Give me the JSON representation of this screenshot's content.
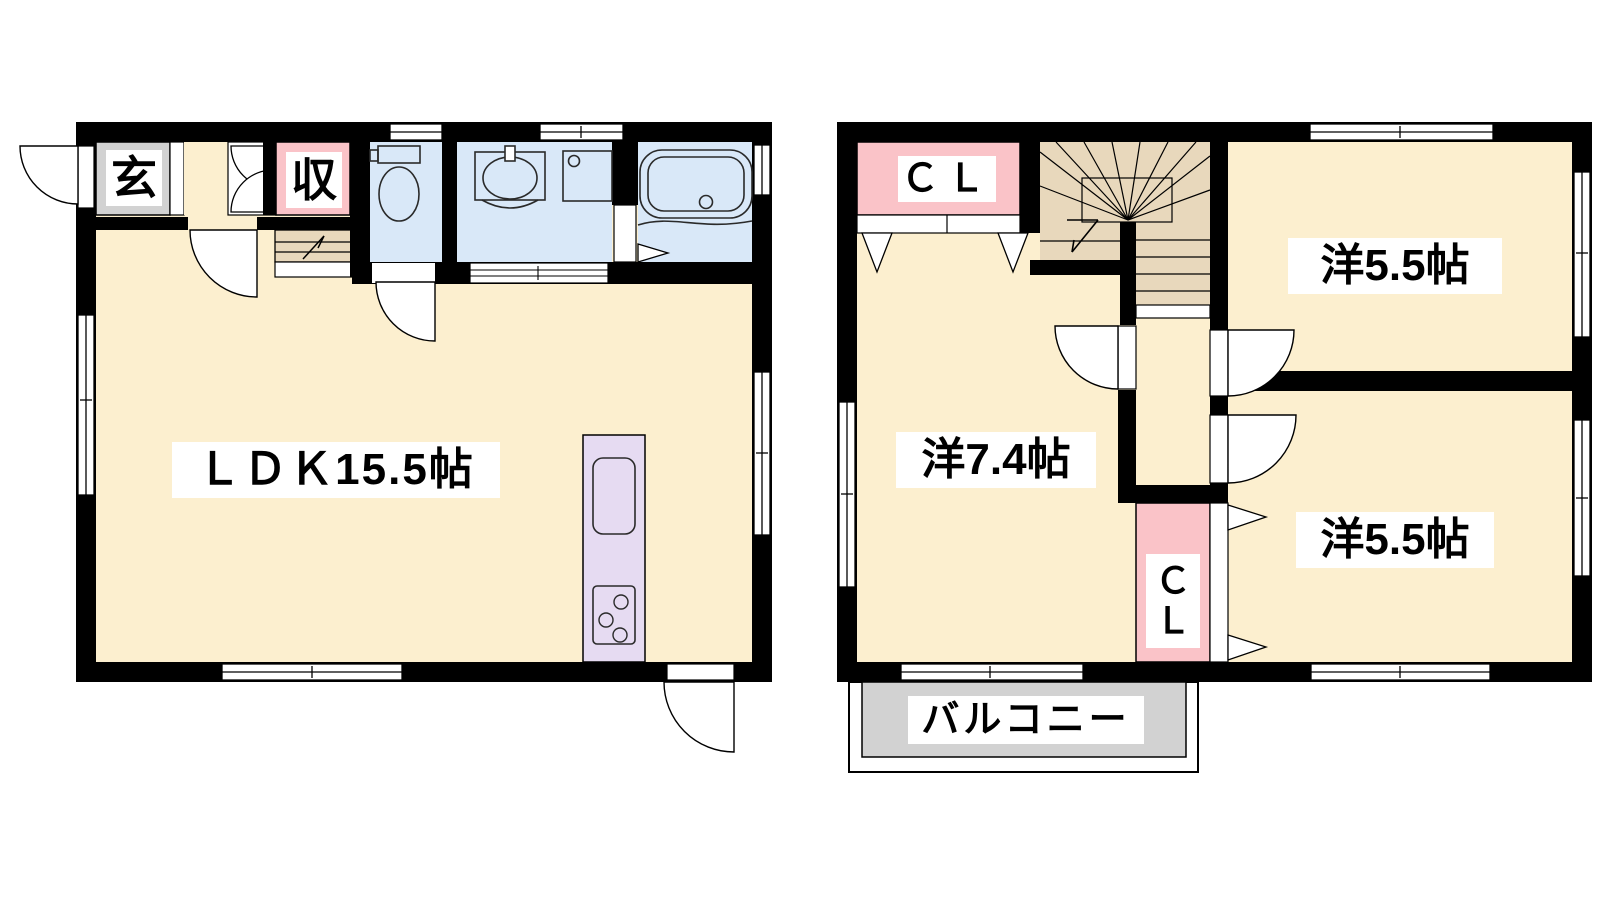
{
  "title": "2-story house floor plan",
  "floor1": {
    "entrance_label": "玄",
    "storage_label": "収",
    "ldk_label": "ＬＤＫ15.5帖",
    "fixtures": [
      "toilet",
      "washbasin",
      "washing-machine",
      "bathtub",
      "kitchen-counter",
      "staircase-start"
    ]
  },
  "floor2": {
    "closet_upper_label": "ＣＬ",
    "room_top_right_label": "洋5.5帖",
    "room_left_label": "洋7.4帖",
    "room_bottom_right_label": "洋5.5帖",
    "closet_lower_char1": "Ｃ",
    "closet_lower_char2": "Ｌ",
    "balcony_label": "バルコニー",
    "fixtures": [
      "winder-staircase",
      "hallway",
      "closets",
      "balcony"
    ]
  },
  "colors": {
    "room_cream": "#FCEFCF",
    "wet_room_blue": "#D9E8F8",
    "closet_pink": "#FAC3C8",
    "stair_tan": "#E8D8BC",
    "kitchen_lavender": "#E6DBF2",
    "entrance_gray": "#D2D2D2",
    "balcony_gray": "#D2D2D2",
    "wall_black": "#000000"
  }
}
